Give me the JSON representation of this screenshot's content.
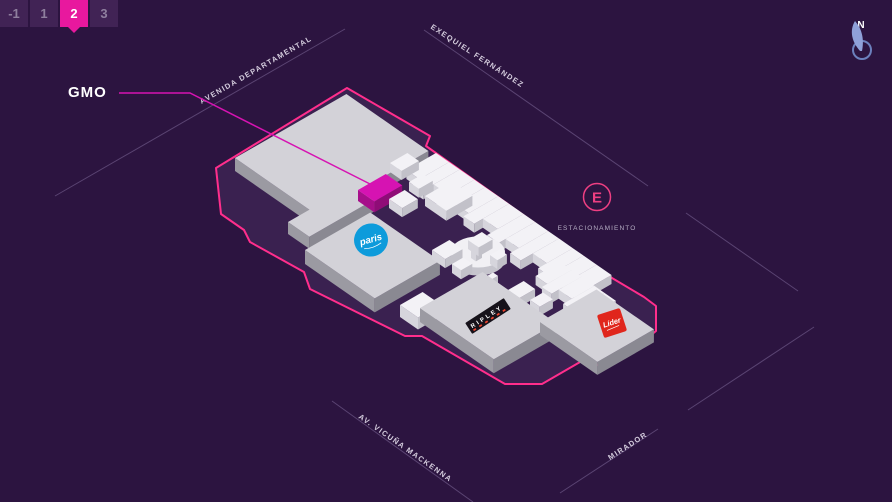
{
  "floor_selector": {
    "floors": [
      "-1",
      "1",
      "2",
      "3"
    ],
    "selected_floor": "2"
  },
  "map": {
    "highlight_label": "GMO",
    "streets": {
      "top_left": "AVENIDA DEPARTAMENTAL",
      "top_right": "EXEQUIEL FERNÁNDEZ",
      "bottom_left": "AV. VICUÑA MACKENNA",
      "bottom_right": "MIRADOR"
    },
    "parking": {
      "symbol": "E",
      "label": "ESTACIONAMIENTO"
    },
    "compass": {
      "label": "N"
    },
    "stores": {
      "paris": {
        "label": "paris",
        "color": "#0d9bdb"
      },
      "ripley": {
        "label": "RIPLEY",
        "color": "#16121a"
      },
      "lider": {
        "label": "Líder",
        "color": "#e0261c"
      }
    },
    "colors": {
      "background": "#2c1440",
      "floor_fill": "#3a2150",
      "outline": "#ff2e8c",
      "highlight": "#d613b2",
      "highlight_dark": "#a60f8a",
      "street_line": "#9a86b8",
      "slab_top": "#d3d2d8",
      "slab_left": "#9b9aa2",
      "slab_right": "#8a8992",
      "box_top": "#f3f2f6",
      "box_left": "#d6d5dc",
      "box_right": "#c2c1c9",
      "badge_pink": "#ee3f82",
      "compass_blue": "#8fa0d8"
    }
  }
}
